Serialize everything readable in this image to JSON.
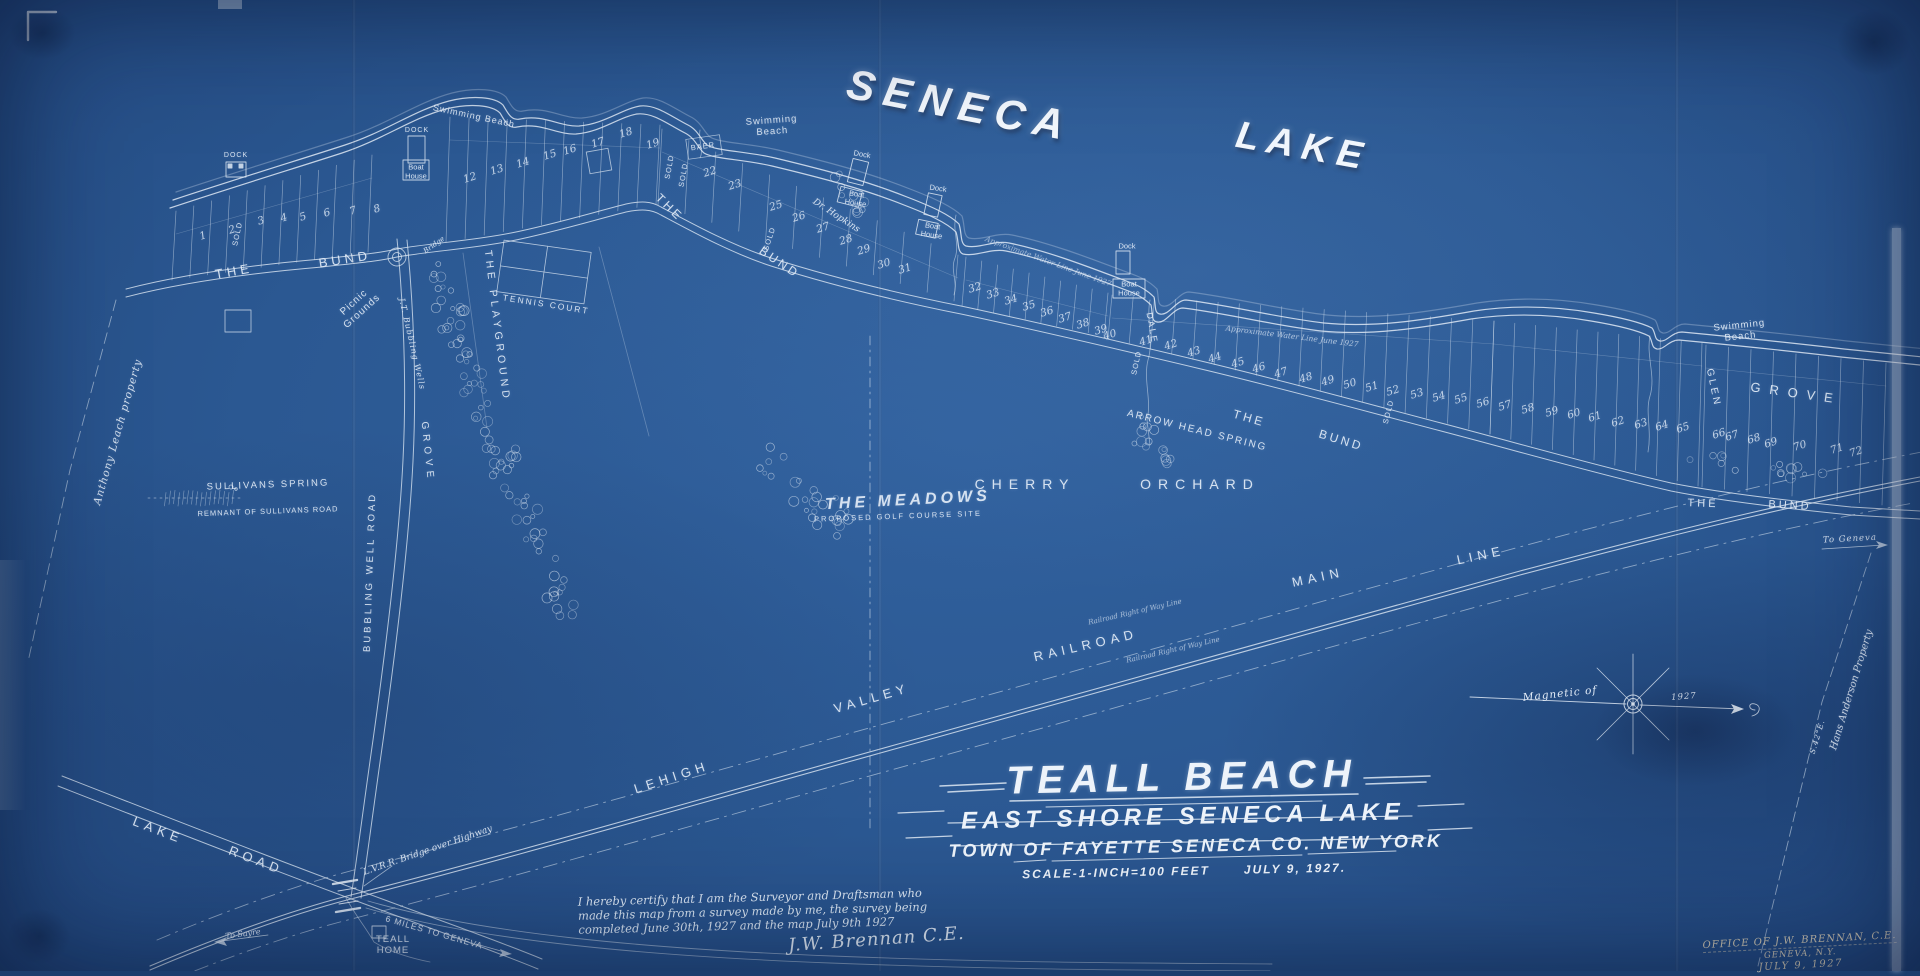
{
  "map": {
    "colors": {
      "paper": "#2b5892",
      "paper_dark": "#1d3f70",
      "ink": "#e4edf8",
      "stamp_ink": "#e6d8ba"
    },
    "big_titles": {
      "seneca": "SENECA",
      "lake": "LAKE"
    },
    "title_block": {
      "main": "TEALL BEACH",
      "sub1": "EAST SHORE SENECA LAKE",
      "sub2": "TOWN OF FAYETTE SENECA CO. NEW YORK",
      "scale": "SCALE-1-INCH=100 FEET",
      "date": "JULY 9, 1927."
    },
    "certification": {
      "text": "I hereby certify that I am the Surveyor and Draftsman who\nmade this map from a survey made by me, the survey being\ncompleted June 30th, 1927 and the map July 9th 1927",
      "signature": "J.W. Brennan C.E."
    },
    "office_stamp": {
      "line1": "OFFICE OF J.W. BRENNAN, C.E.",
      "line2": "GENEVA, N.Y.",
      "line3": "JULY 9, 1927"
    },
    "compass": {
      "label": "Magnetic of",
      "year": "1927"
    },
    "labels": [
      {
        "id": "swimming-beach-1",
        "t": "Swimming Beach",
        "x": 474,
        "y": 116,
        "r": 12,
        "fs": 9,
        "ls": 1
      },
      {
        "id": "swimming-beach-2",
        "t": "Swimming\nBeach",
        "x": 772,
        "y": 127,
        "r": -4,
        "fs": 9.5,
        "ls": 1
      },
      {
        "id": "swimming-beach-3",
        "t": "Swimming\nBeach",
        "x": 1740,
        "y": 332,
        "r": -6,
        "fs": 9.5,
        "ls": 1
      },
      {
        "id": "dock-label-1",
        "t": "DOCK",
        "x": 236,
        "y": 156,
        "r": 0,
        "fs": 7,
        "ls": 1
      },
      {
        "id": "dock-label-2",
        "t": "DOCK",
        "x": 417,
        "y": 131,
        "r": 0,
        "fs": 7,
        "ls": 1
      },
      {
        "id": "boathouse-label-2",
        "t": "Boat\nHouse",
        "x": 416,
        "y": 172,
        "r": 0,
        "fs": 7.5,
        "ls": 0
      },
      {
        "id": "dock-label-3",
        "t": "Dock",
        "x": 862,
        "y": 155,
        "r": 10,
        "fs": 7.5,
        "ls": 0
      },
      {
        "id": "boathouse-label-3",
        "t": "Boat\nHouse",
        "x": 856,
        "y": 199,
        "r": 8,
        "fs": 7.5,
        "ls": 0
      },
      {
        "id": "dock-label-4",
        "t": "Dock",
        "x": 938,
        "y": 189,
        "r": 8,
        "fs": 7.5,
        "ls": 0
      },
      {
        "id": "boathouse-label-4",
        "t": "Boat\nHouse",
        "x": 932,
        "y": 231,
        "r": 8,
        "fs": 7.5,
        "ls": 0
      },
      {
        "id": "dock-label-5",
        "t": "Dock",
        "x": 1127,
        "y": 247,
        "r": 0,
        "fs": 7.5,
        "ls": 0
      },
      {
        "id": "boathouse-label-5",
        "t": "Boat\nHouse",
        "x": 1129,
        "y": 289,
        "r": 0,
        "fs": 7.5,
        "ls": 0
      },
      {
        "id": "the-bund-1-the",
        "t": "THE",
        "x": 234,
        "y": 272,
        "r": -10,
        "fs": 13,
        "ls": 4
      },
      {
        "id": "the-bund-1-bund",
        "t": "BUND",
        "x": 345,
        "y": 260,
        "r": -9,
        "fs": 13,
        "ls": 4
      },
      {
        "id": "the-bund-2-the",
        "t": "THE",
        "x": 669,
        "y": 208,
        "r": 44,
        "fs": 12,
        "ls": 3
      },
      {
        "id": "the-bund-2-bund",
        "t": "BUND",
        "x": 779,
        "y": 263,
        "r": 34,
        "fs": 12,
        "ls": 3
      },
      {
        "id": "the-bund-3-the",
        "t": "THE",
        "x": 1249,
        "y": 419,
        "r": 16,
        "fs": 12,
        "ls": 3
      },
      {
        "id": "the-bund-3-bund",
        "t": "BUND",
        "x": 1341,
        "y": 441,
        "r": 17,
        "fs": 12,
        "ls": 3
      },
      {
        "id": "the-bund-4-the",
        "t": "THE",
        "x": 1703,
        "y": 504,
        "r": 2,
        "fs": 11,
        "ls": 3
      },
      {
        "id": "the-bund-4-bund",
        "t": "BUND",
        "x": 1790,
        "y": 506,
        "r": 3,
        "fs": 11,
        "ls": 3
      },
      {
        "id": "picnic-grounds",
        "t": "Picnic\nGrounds",
        "x": 358,
        "y": 307,
        "r": -42,
        "fs": 10,
        "ls": 1
      },
      {
        "id": "tennis-court",
        "t": "TENNIS COURT",
        "x": 546,
        "y": 305,
        "r": 9,
        "fs": 8.5,
        "ls": 2
      },
      {
        "id": "the-playground",
        "t": "THE PLAYGROUND",
        "x": 497,
        "y": 326,
        "r": 83,
        "fs": 10.5,
        "ls": 4
      },
      {
        "id": "bubbling-well-road",
        "t": "BUBBLING WELL ROAD",
        "x": 371,
        "y": 572,
        "r": -88,
        "fs": 9.5,
        "ls": 3
      },
      {
        "id": "bubbling-wells-grove",
        "t": "J.T. Bubbling Wells",
        "x": 412,
        "y": 344,
        "r": 77,
        "fs": 8,
        "ls": 1,
        "cls": "script"
      },
      {
        "id": "bubbling-wells-grove-2",
        "t": "GROVE",
        "x": 427,
        "y": 452,
        "r": 84,
        "fs": 10,
        "ls": 5
      },
      {
        "id": "bridge-label",
        "t": "Bridge",
        "x": 434,
        "y": 245,
        "r": -35,
        "fs": 7,
        "ls": 0,
        "cls": "script"
      },
      {
        "id": "sullivans-spring",
        "t": "SULLIVANS SPRING",
        "x": 268,
        "y": 486,
        "r": -2,
        "fs": 9.5,
        "ls": 2
      },
      {
        "id": "sullivans-road",
        "t": "REMNANT OF SULLIVANS ROAD",
        "x": 268,
        "y": 512,
        "r": -2,
        "fs": 7.5,
        "ls": 1
      },
      {
        "id": "leach-property",
        "t": "Anthony Leach property",
        "x": 118,
        "y": 432,
        "r": -74,
        "fs": 10.5,
        "ls": 1,
        "cls": "script"
      },
      {
        "id": "the-meadows",
        "t": "THE MEADOWS",
        "x": 908,
        "y": 501,
        "r": -3,
        "fs": 16,
        "ls": 4,
        "cls": "big-italic"
      },
      {
        "id": "golf-course-site",
        "t": "PROPOSED GOLF COURSE SITE",
        "x": 898,
        "y": 517,
        "r": -2,
        "fs": 7.5,
        "ls": 2
      },
      {
        "id": "cherry",
        "t": "CHERRY",
        "x": 1025,
        "y": 484,
        "r": 0,
        "fs": 14,
        "ls": 7
      },
      {
        "id": "orchard",
        "t": "ORCHARD",
        "x": 1200,
        "y": 484,
        "r": 0,
        "fs": 14,
        "ls": 7
      },
      {
        "id": "arrow-head-spring",
        "t": "ARROW HEAD SPRING",
        "x": 1197,
        "y": 431,
        "r": 14,
        "fs": 10,
        "ls": 2
      },
      {
        "id": "water-line-1",
        "t": "Approximate Water Line June 1927",
        "x": 1048,
        "y": 262,
        "r": 20,
        "fs": 7.5,
        "ls": 0,
        "cls": "script",
        "op": 0.6
      },
      {
        "id": "water-line-2",
        "t": "Approximate Water Line June 1927",
        "x": 1292,
        "y": 337,
        "r": 7,
        "fs": 7.5,
        "ls": 0,
        "cls": "script",
        "op": 0.7
      },
      {
        "id": "dale",
        "t": "DALE",
        "x": 1152,
        "y": 328,
        "r": 80,
        "fs": 9,
        "ls": 2
      },
      {
        "id": "glen",
        "t": "GLEN",
        "x": 1713,
        "y": 388,
        "r": 78,
        "fs": 10,
        "ls": 3
      },
      {
        "id": "grove-right",
        "t": "GROVE",
        "x": 1796,
        "y": 394,
        "r": 8,
        "fs": 13,
        "ls": 9
      },
      {
        "id": "to-geneva",
        "t": "To Geneva",
        "x": 1850,
        "y": 540,
        "r": -3,
        "fs": 8.5,
        "ls": 1,
        "cls": "script"
      },
      {
        "id": "anderson-property",
        "t": "Hans Anderson Property",
        "x": 1852,
        "y": 690,
        "r": -73,
        "fs": 10,
        "ls": 0,
        "cls": "script"
      },
      {
        "id": "bearing-s42e",
        "t": "S.42°E.",
        "x": 1818,
        "y": 737,
        "r": -73,
        "fs": 7.5,
        "ls": 1,
        "cls": "script"
      },
      {
        "id": "railroad-lehigh",
        "t": "LEHIGH",
        "x": 672,
        "y": 778,
        "r": -18,
        "fs": 13,
        "ls": 5
      },
      {
        "id": "railroad-valley",
        "t": "VALLEY",
        "x": 872,
        "y": 699,
        "r": -16,
        "fs": 13,
        "ls": 5
      },
      {
        "id": "railroad-railroad",
        "t": "RAILROAD",
        "x": 1086,
        "y": 646,
        "r": -13,
        "fs": 13,
        "ls": 5
      },
      {
        "id": "railroad-main",
        "t": "MAIN",
        "x": 1318,
        "y": 578,
        "r": -12,
        "fs": 13,
        "ls": 5
      },
      {
        "id": "railroad-line",
        "t": "LINE",
        "x": 1481,
        "y": 556,
        "r": -12,
        "fs": 13,
        "ls": 5
      },
      {
        "id": "row-line-1",
        "t": "Railroad Right of Way Line",
        "x": 1135,
        "y": 612,
        "r": -13,
        "fs": 7,
        "ls": 0,
        "cls": "script",
        "op": 0.65
      },
      {
        "id": "row-line-2",
        "t": "Railroad Right of Way Line",
        "x": 1173,
        "y": 650,
        "r": -13,
        "fs": 7,
        "ls": 0,
        "cls": "script",
        "op": 0.65
      },
      {
        "id": "lake-road-lake",
        "t": "LAKE",
        "x": 158,
        "y": 831,
        "r": 21,
        "fs": 13,
        "ls": 5
      },
      {
        "id": "lake-road-road",
        "t": "ROAD",
        "x": 256,
        "y": 861,
        "r": 21,
        "fs": 13,
        "ls": 5
      },
      {
        "id": "lvrr-bridge",
        "t": "L.V.R.R. Bridge over Highway",
        "x": 428,
        "y": 851,
        "r": -19,
        "fs": 9,
        "ls": 0,
        "cls": "script"
      },
      {
        "id": "to-sayre",
        "t": "To Sayre",
        "x": 243,
        "y": 934,
        "r": -8,
        "fs": 8,
        "ls": 0,
        "cls": "script"
      },
      {
        "id": "miles-to-geneva",
        "t": "6 MILES TO GENEVA",
        "x": 434,
        "y": 933,
        "r": 16,
        "fs": 8.5,
        "ls": 1
      },
      {
        "id": "teall-home",
        "t": "TEALL\nHOME",
        "x": 393,
        "y": 946,
        "r": 0,
        "fs": 9.5,
        "ls": 1
      },
      {
        "id": "sold-1",
        "t": "SOLD",
        "x": 238,
        "y": 234,
        "r": -78,
        "fs": 7.5,
        "ls": 1
      },
      {
        "id": "sold-2",
        "t": "SOLD",
        "x": 670,
        "y": 167,
        "r": -80,
        "fs": 7.5,
        "ls": 1
      },
      {
        "id": "sold-3",
        "t": "SOLD",
        "x": 684,
        "y": 175,
        "r": -80,
        "fs": 7.5,
        "ls": 1
      },
      {
        "id": "sold-4",
        "t": "SOLD",
        "x": 770,
        "y": 239,
        "r": -72,
        "fs": 7.5,
        "ls": 1
      },
      {
        "id": "sold-5",
        "t": "SOLD",
        "x": 1137,
        "y": 363,
        "r": -78,
        "fs": 7.5,
        "ls": 1
      },
      {
        "id": "sold-6",
        "t": "SOLD",
        "x": 1389,
        "y": 412,
        "r": -76,
        "fs": 7.5,
        "ls": 1
      },
      {
        "id": "baer",
        "t": "BAER",
        "x": 703,
        "y": 147,
        "r": -8,
        "fs": 7.5,
        "ls": 1
      },
      {
        "id": "dr-hopkins",
        "t": "Dr. Hopkins",
        "x": 836,
        "y": 216,
        "r": 33,
        "fs": 9,
        "ls": 0,
        "cls": "script"
      }
    ],
    "lots": [
      {
        "n": "1",
        "x": 203,
        "y": 236
      },
      {
        "n": "2",
        "x": 232,
        "y": 230
      },
      {
        "n": "3",
        "x": 261,
        "y": 221
      },
      {
        "n": "4",
        "x": 284,
        "y": 218
      },
      {
        "n": "5",
        "x": 303,
        "y": 217
      },
      {
        "n": "6",
        "x": 327,
        "y": 213
      },
      {
        "n": "7",
        "x": 353,
        "y": 211
      },
      {
        "n": "8",
        "x": 377,
        "y": 209
      },
      {
        "n": "12",
        "x": 470,
        "y": 178
      },
      {
        "n": "13",
        "x": 497,
        "y": 170
      },
      {
        "n": "14",
        "x": 523,
        "y": 163
      },
      {
        "n": "15",
        "x": 550,
        "y": 155
      },
      {
        "n": "16",
        "x": 570,
        "y": 150
      },
      {
        "n": "17",
        "x": 598,
        "y": 143
      },
      {
        "n": "18",
        "x": 626,
        "y": 133
      },
      {
        "n": "19",
        "x": 653,
        "y": 144
      },
      {
        "n": "22",
        "x": 710,
        "y": 172
      },
      {
        "n": "23",
        "x": 735,
        "y": 185
      },
      {
        "n": "25",
        "x": 776,
        "y": 206
      },
      {
        "n": "26",
        "x": 799,
        "y": 217
      },
      {
        "n": "27",
        "x": 823,
        "y": 228
      },
      {
        "n": "28",
        "x": 846,
        "y": 240
      },
      {
        "n": "29",
        "x": 864,
        "y": 250
      },
      {
        "n": "30",
        "x": 884,
        "y": 264
      },
      {
        "n": "31",
        "x": 905,
        "y": 269
      },
      {
        "n": "32",
        "x": 975,
        "y": 288
      },
      {
        "n": "33",
        "x": 993,
        "y": 294
      },
      {
        "n": "34",
        "x": 1011,
        "y": 300
      },
      {
        "n": "35",
        "x": 1029,
        "y": 306
      },
      {
        "n": "36",
        "x": 1047,
        "y": 312
      },
      {
        "n": "37",
        "x": 1065,
        "y": 318
      },
      {
        "n": "38",
        "x": 1083,
        "y": 324
      },
      {
        "n": "39",
        "x": 1101,
        "y": 330
      },
      {
        "n": "40",
        "x": 1110,
        "y": 335
      },
      {
        "n": "41",
        "x": 1146,
        "y": 341
      },
      {
        "n": "42",
        "x": 1171,
        "y": 345
      },
      {
        "n": "43",
        "x": 1194,
        "y": 352
      },
      {
        "n": "44",
        "x": 1215,
        "y": 358
      },
      {
        "n": "45",
        "x": 1238,
        "y": 363
      },
      {
        "n": "46",
        "x": 1259,
        "y": 368
      },
      {
        "n": "47",
        "x": 1281,
        "y": 373
      },
      {
        "n": "48",
        "x": 1306,
        "y": 378
      },
      {
        "n": "49",
        "x": 1328,
        "y": 381
      },
      {
        "n": "50",
        "x": 1350,
        "y": 384
      },
      {
        "n": "51",
        "x": 1372,
        "y": 387
      },
      {
        "n": "52",
        "x": 1393,
        "y": 391
      },
      {
        "n": "53",
        "x": 1417,
        "y": 394
      },
      {
        "n": "54",
        "x": 1439,
        "y": 397
      },
      {
        "n": "55",
        "x": 1461,
        "y": 399
      },
      {
        "n": "56",
        "x": 1483,
        "y": 403
      },
      {
        "n": "57",
        "x": 1505,
        "y": 406
      },
      {
        "n": "58",
        "x": 1528,
        "y": 409
      },
      {
        "n": "59",
        "x": 1552,
        "y": 412
      },
      {
        "n": "60",
        "x": 1574,
        "y": 414
      },
      {
        "n": "61",
        "x": 1595,
        "y": 417
      },
      {
        "n": "62",
        "x": 1618,
        "y": 422
      },
      {
        "n": "63",
        "x": 1641,
        "y": 424
      },
      {
        "n": "64",
        "x": 1662,
        "y": 426
      },
      {
        "n": "65",
        "x": 1683,
        "y": 428
      },
      {
        "n": "66",
        "x": 1719,
        "y": 434
      },
      {
        "n": "67",
        "x": 1732,
        "y": 436
      },
      {
        "n": "68",
        "x": 1754,
        "y": 439
      },
      {
        "n": "69",
        "x": 1771,
        "y": 443
      },
      {
        "n": "70",
        "x": 1800,
        "y": 446
      },
      {
        "n": "71",
        "x": 1837,
        "y": 449
      },
      {
        "n": "72",
        "x": 1856,
        "y": 452
      }
    ]
  }
}
